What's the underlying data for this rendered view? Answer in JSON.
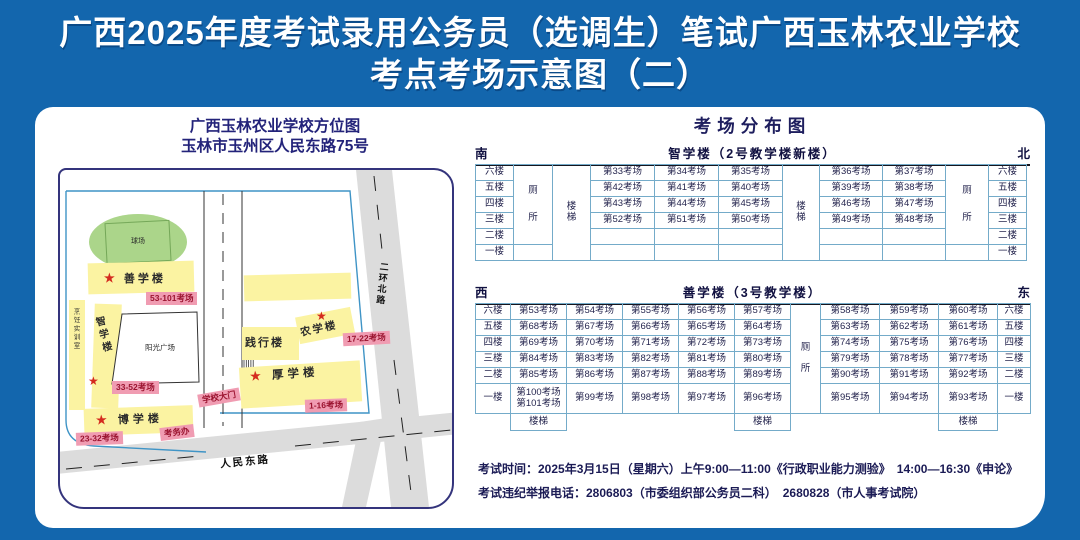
{
  "title": {
    "line1": "广西2025年度考试录用公务员（选调生）笔试广西玉林农业学校",
    "line2": "考点考场示意图（二）"
  },
  "map": {
    "title_line1": "广西玉林农业学校方位图",
    "title_line2": "玉林市玉州区人民东路75号",
    "glyphs": {
      "star": "★"
    },
    "labels": {
      "ballfield": "球场",
      "shanxue": "善学楼",
      "shanxue_tag": "53-101考场",
      "pengren": "烹饪实训室",
      "zhixue": "智学楼",
      "zhixue_tag": "33-52考场",
      "plaza": "阳光广场",
      "boxue": "博学楼",
      "boxue_tag": "23-32考场",
      "kaowuban": "考务办",
      "gate": "学校大门",
      "jianxing": "践行楼",
      "nongxue": "农学楼",
      "nongxue_tag": "17-22考场",
      "houxue": "厚学楼",
      "houxue_tag": "1-16考场",
      "renmin_road": "人民东路",
      "erhuan_road": "二环北路"
    }
  },
  "distribution": {
    "title": "考场分布图",
    "buildings": [
      {
        "layout": "A",
        "dir_left": "南",
        "name": "智学楼（2号教学楼新楼）",
        "dir_right": "北",
        "floors": [
          "六楼",
          "五楼",
          "四楼",
          "三楼",
          "二楼",
          "一楼"
        ],
        "wc": "厕所",
        "stair": "楼梯",
        "left": [
          [
            "第33考场",
            "第34考场",
            "第35考场"
          ],
          [
            "第42考场",
            "第41考场",
            "第40考场"
          ],
          [
            "第43考场",
            "第44考场",
            "第45考场"
          ],
          [
            "第52考场",
            "第51考场",
            "第50考场"
          ],
          [
            "",
            "",
            ""
          ],
          [
            "",
            "",
            ""
          ]
        ],
        "right": [
          [
            "第36考场",
            "第37考场"
          ],
          [
            "第39考场",
            "第38考场"
          ],
          [
            "第46考场",
            "第47考场"
          ],
          [
            "第49考场",
            "第48考场"
          ],
          [
            "",
            ""
          ],
          [
            "",
            ""
          ]
        ]
      },
      {
        "layout": "B",
        "dir_left": "西",
        "name": "善学楼（3号教学楼）",
        "dir_right": "东",
        "floors": [
          "六楼",
          "五楼",
          "四楼",
          "三楼",
          "二楼",
          "一楼"
        ],
        "wc": "厕所",
        "stair_label": "楼梯",
        "left": [
          [
            "第53考场",
            "第54考场",
            "第55考场",
            "第56考场",
            "第57考场"
          ],
          [
            "第68考场",
            "第67考场",
            "第66考场",
            "第65考场",
            "第64考场"
          ],
          [
            "第69考场",
            "第70考场",
            "第71考场",
            "第72考场",
            "第73考场"
          ],
          [
            "第84考场",
            "第83考场",
            "第82考场",
            "第81考场",
            "第80考场"
          ],
          [
            "第85考场",
            "第86考场",
            "第87考场",
            "第88考场",
            "第89考场"
          ],
          [
            "第100考场|第101考场",
            "第99考场",
            "第98考场",
            "第97考场",
            "第96考场"
          ]
        ],
        "right": [
          [
            "第58考场",
            "第59考场",
            "第60考场"
          ],
          [
            "第63考场",
            "第62考场",
            "第61考场"
          ],
          [
            "第74考场",
            "第75考场",
            "第76考场"
          ],
          [
            "第79考场",
            "第78考场",
            "第77考场"
          ],
          [
            "第90考场",
            "第91考场",
            "第92考场"
          ],
          [
            "第95考场",
            "第94考场",
            "第93考场"
          ]
        ]
      }
    ]
  },
  "footer": {
    "line1": "考试时间：2025年3月15日（星期六）上午9:00—11:00《行政职业能力测验》　14:00—16:30《申论》",
    "line2": "考试违纪举报电话：2806803（市委组织部公务员二科）　2680828（市人事考试院）"
  },
  "colors": {
    "bg_blue": "#1366ad",
    "navy": "#1b1b55",
    "table_border": "#74abc9",
    "building_yellow": "#fbf3a2",
    "tag_pink": "#f09cb2",
    "tag_text": "#9b1430",
    "field_green": "#abd58a",
    "road_gray": "#dcdcdc",
    "star_red": "#d42a1e"
  }
}
